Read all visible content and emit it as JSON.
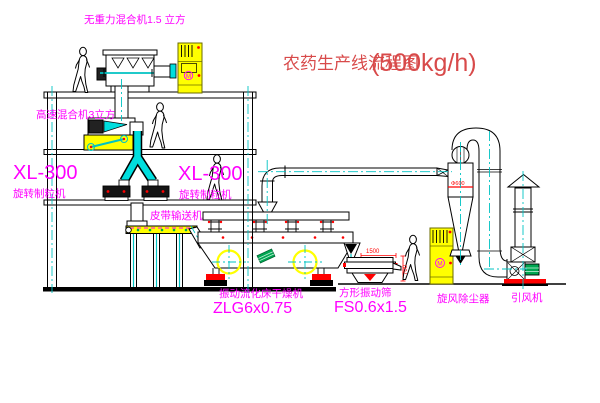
{
  "drawing": {
    "title": {
      "name": "农药生产线流程图",
      "capacity": "(500kg/h)"
    },
    "equipment_labels": {
      "gravity_mixer": "无重力混合机1.5 立方",
      "high_speed_mixer": "高速混合机3立方",
      "granulator_left_model": "XL-300",
      "granulator_left_name": "旋转制粒机",
      "granulator_right_model": "XL-300",
      "granulator_right_name": "旋转制粒机",
      "belt_conveyor": "皮带输送机",
      "fluid_bed_dryer_name": "振动流化床干燥机",
      "fluid_bed_dryer_model": "ZLG6x0.75",
      "square_sieve_name": "方形振动筛",
      "square_sieve_model": "FS0.6x1.5",
      "cyclone": "旋风除尘器",
      "induced_draft_fan": "引风机",
      "motor_symbol": "M"
    },
    "dimensions": {
      "sieve_length": "1500",
      "sieve_outlet_height": "700",
      "cyclone_diameter": "Φ600"
    },
    "colors": {
      "line": "#000000",
      "centerline": "#00C3C3",
      "label": "#FF00FF",
      "title": "#D84A4A",
      "highlight": "#FFFF00",
      "dimension": "#FF0000",
      "motor_green": "#00A651",
      "background": "#FFFFFF"
    }
  }
}
